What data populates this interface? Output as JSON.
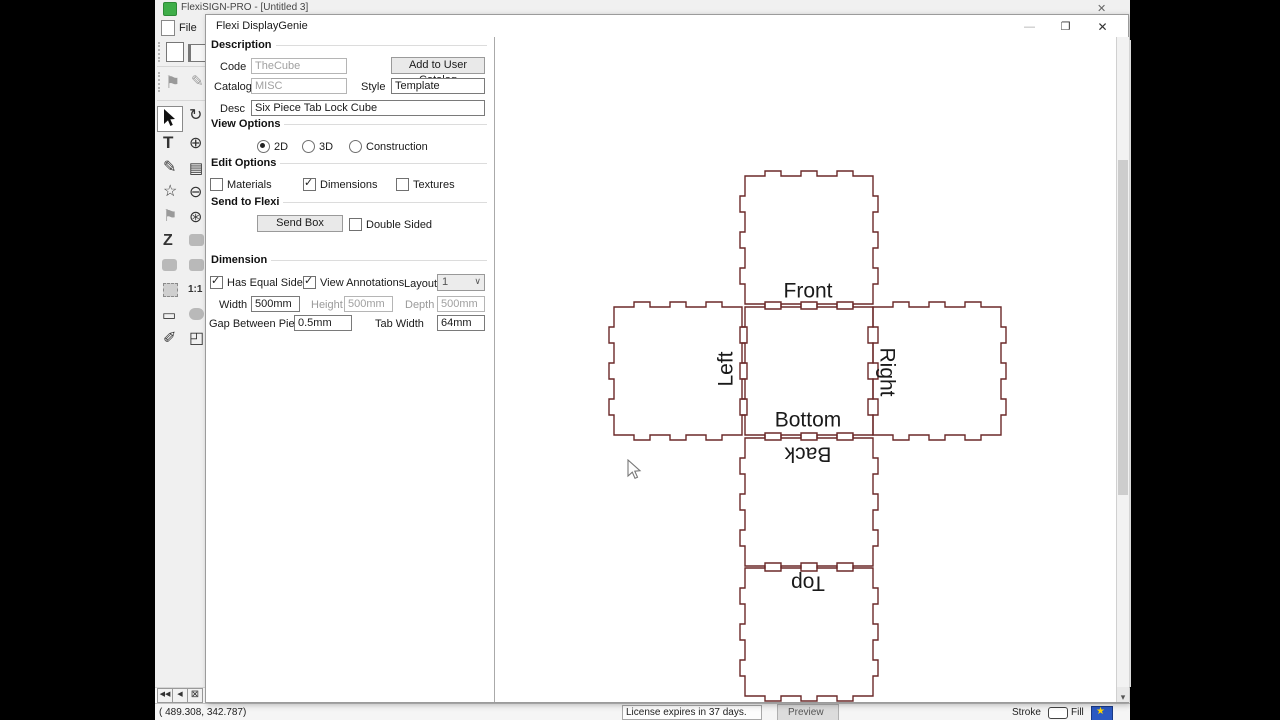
{
  "window": {
    "title": "FlexiSIGN-PRO - [Untitled 3]",
    "close": "✕",
    "file_menu": "File"
  },
  "dialog": {
    "title": "Flexi DisplayGenie",
    "minimize": "—",
    "maximize": "❐",
    "close": "✕",
    "description": {
      "header": "Description",
      "code_label": "Code",
      "code_value": "TheCube",
      "add_button": "Add to User Catalog",
      "catalog_label": "Catalog",
      "catalog_value": "MISC",
      "style_label": "Style",
      "style_value": "Template",
      "desc_label": "Desc",
      "desc_value": "Six Piece Tab Lock Cube"
    },
    "view_options": {
      "header": "View Options",
      "radio_2d": {
        "label": "2D",
        "selected": true
      },
      "radio_3d": {
        "label": "3D",
        "selected": false
      },
      "radio_construction": {
        "label": "Construction",
        "selected": false
      }
    },
    "edit_options": {
      "header": "Edit Options",
      "materials": {
        "label": "Materials",
        "checked": false
      },
      "dimensions": {
        "label": "Dimensions",
        "checked": true
      },
      "textures": {
        "label": "Textures",
        "checked": false
      }
    },
    "send": {
      "header": "Send to Flexi",
      "send_button": "Send Box",
      "double_sided": {
        "label": "Double Sided",
        "checked": false
      }
    },
    "dimension": {
      "header": "Dimension",
      "has_equal_sides": {
        "label": "Has Equal Sides",
        "checked": true
      },
      "view_annotations": {
        "label": "View Annotations",
        "checked": true
      },
      "layout_label": "Layout",
      "layout_value": "1",
      "width_label": "Width",
      "width_value": "500mm",
      "height_label": "Height",
      "height_value": "500mm",
      "depth_label": "Depth",
      "depth_value": "500mm",
      "gap_label": "Gap Between Pieces",
      "gap_value": "0.5mm",
      "tab_width_label": "Tab Width",
      "tab_width_value": "64mm"
    }
  },
  "preview": {
    "stroke_color": "#6b2929",
    "label_color": "#1a1a1a",
    "panel_size": 128,
    "tab_width": 16,
    "tab_height": 5,
    "panels": [
      {
        "name": "front",
        "label": "Front",
        "x": 744,
        "y": 175,
        "lx": 807,
        "ly": 291,
        "rot": 0
      },
      {
        "name": "left",
        "label": "Left",
        "x": 613,
        "y": 306,
        "lx": 726,
        "ly": 368,
        "rot": -90
      },
      {
        "name": "bottom",
        "label": "Bottom",
        "x": 744,
        "y": 306,
        "lx": 807,
        "ly": 420,
        "rot": 0
      },
      {
        "name": "right",
        "label": "Right",
        "x": 872,
        "y": 306,
        "lx": 885,
        "ly": 371,
        "rot": 90
      },
      {
        "name": "back",
        "label": "Back",
        "x": 744,
        "y": 437,
        "lx": 807,
        "ly": 452,
        "rot": 180
      },
      {
        "name": "top",
        "label": "Top",
        "x": 744,
        "y": 567,
        "lx": 807,
        "ly": 581,
        "rot": 180
      }
    ]
  },
  "statusbar": {
    "coords": "(  489.308,    342.787)",
    "license": "License expires in 37 days.",
    "preview_tab": "Preview",
    "stroke_label": "Stroke",
    "fill_label": "Fill"
  },
  "icons": {
    "rotate": "↻",
    "zoom_in": "⊕",
    "page": "▤",
    "zoom_out": "⊖",
    "zoom_select": "⊛",
    "one_to_one": "1:1",
    "corner_view": "◰",
    "text_tool": "T",
    "pen": "✎",
    "star": "☆",
    "flag": "⚑",
    "effects_z": "Z",
    "ruler": "▭",
    "eyedropper": "✐",
    "dropdown": "∨",
    "scroll_down": "▾",
    "nav_first": "◀◀",
    "nav_prev": "◀",
    "nav_close": "⊠",
    "fill_star": "★"
  }
}
